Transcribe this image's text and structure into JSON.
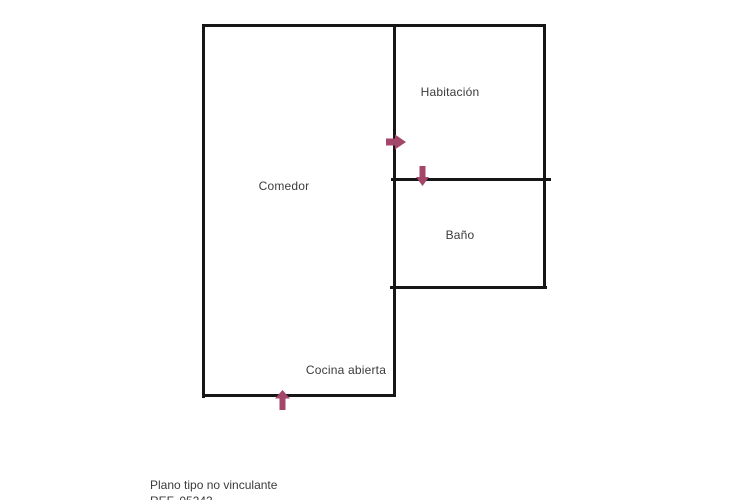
{
  "floor_plan": {
    "rooms": [
      {
        "id": "comedor",
        "label": "Comedor"
      },
      {
        "id": "habitacion",
        "label": "Habitación"
      },
      {
        "id": "bano",
        "label": "Baño"
      },
      {
        "id": "cocina-abierta",
        "label": "Cocina abierta"
      }
    ],
    "entrance_arrows": [
      {
        "id": "comedor-to-habitacion",
        "direction": "right"
      },
      {
        "id": "habitacion-to-bano",
        "direction": "down"
      },
      {
        "id": "main-entrance",
        "direction": "up"
      }
    ],
    "colors": {
      "wall": "#161616",
      "arrow": "#a34669",
      "label": "#3b3b3b",
      "background": "#ffffff"
    }
  },
  "footer": {
    "disclaimer": "Plano tipo no vinculante",
    "reference": "REF. 05243"
  }
}
